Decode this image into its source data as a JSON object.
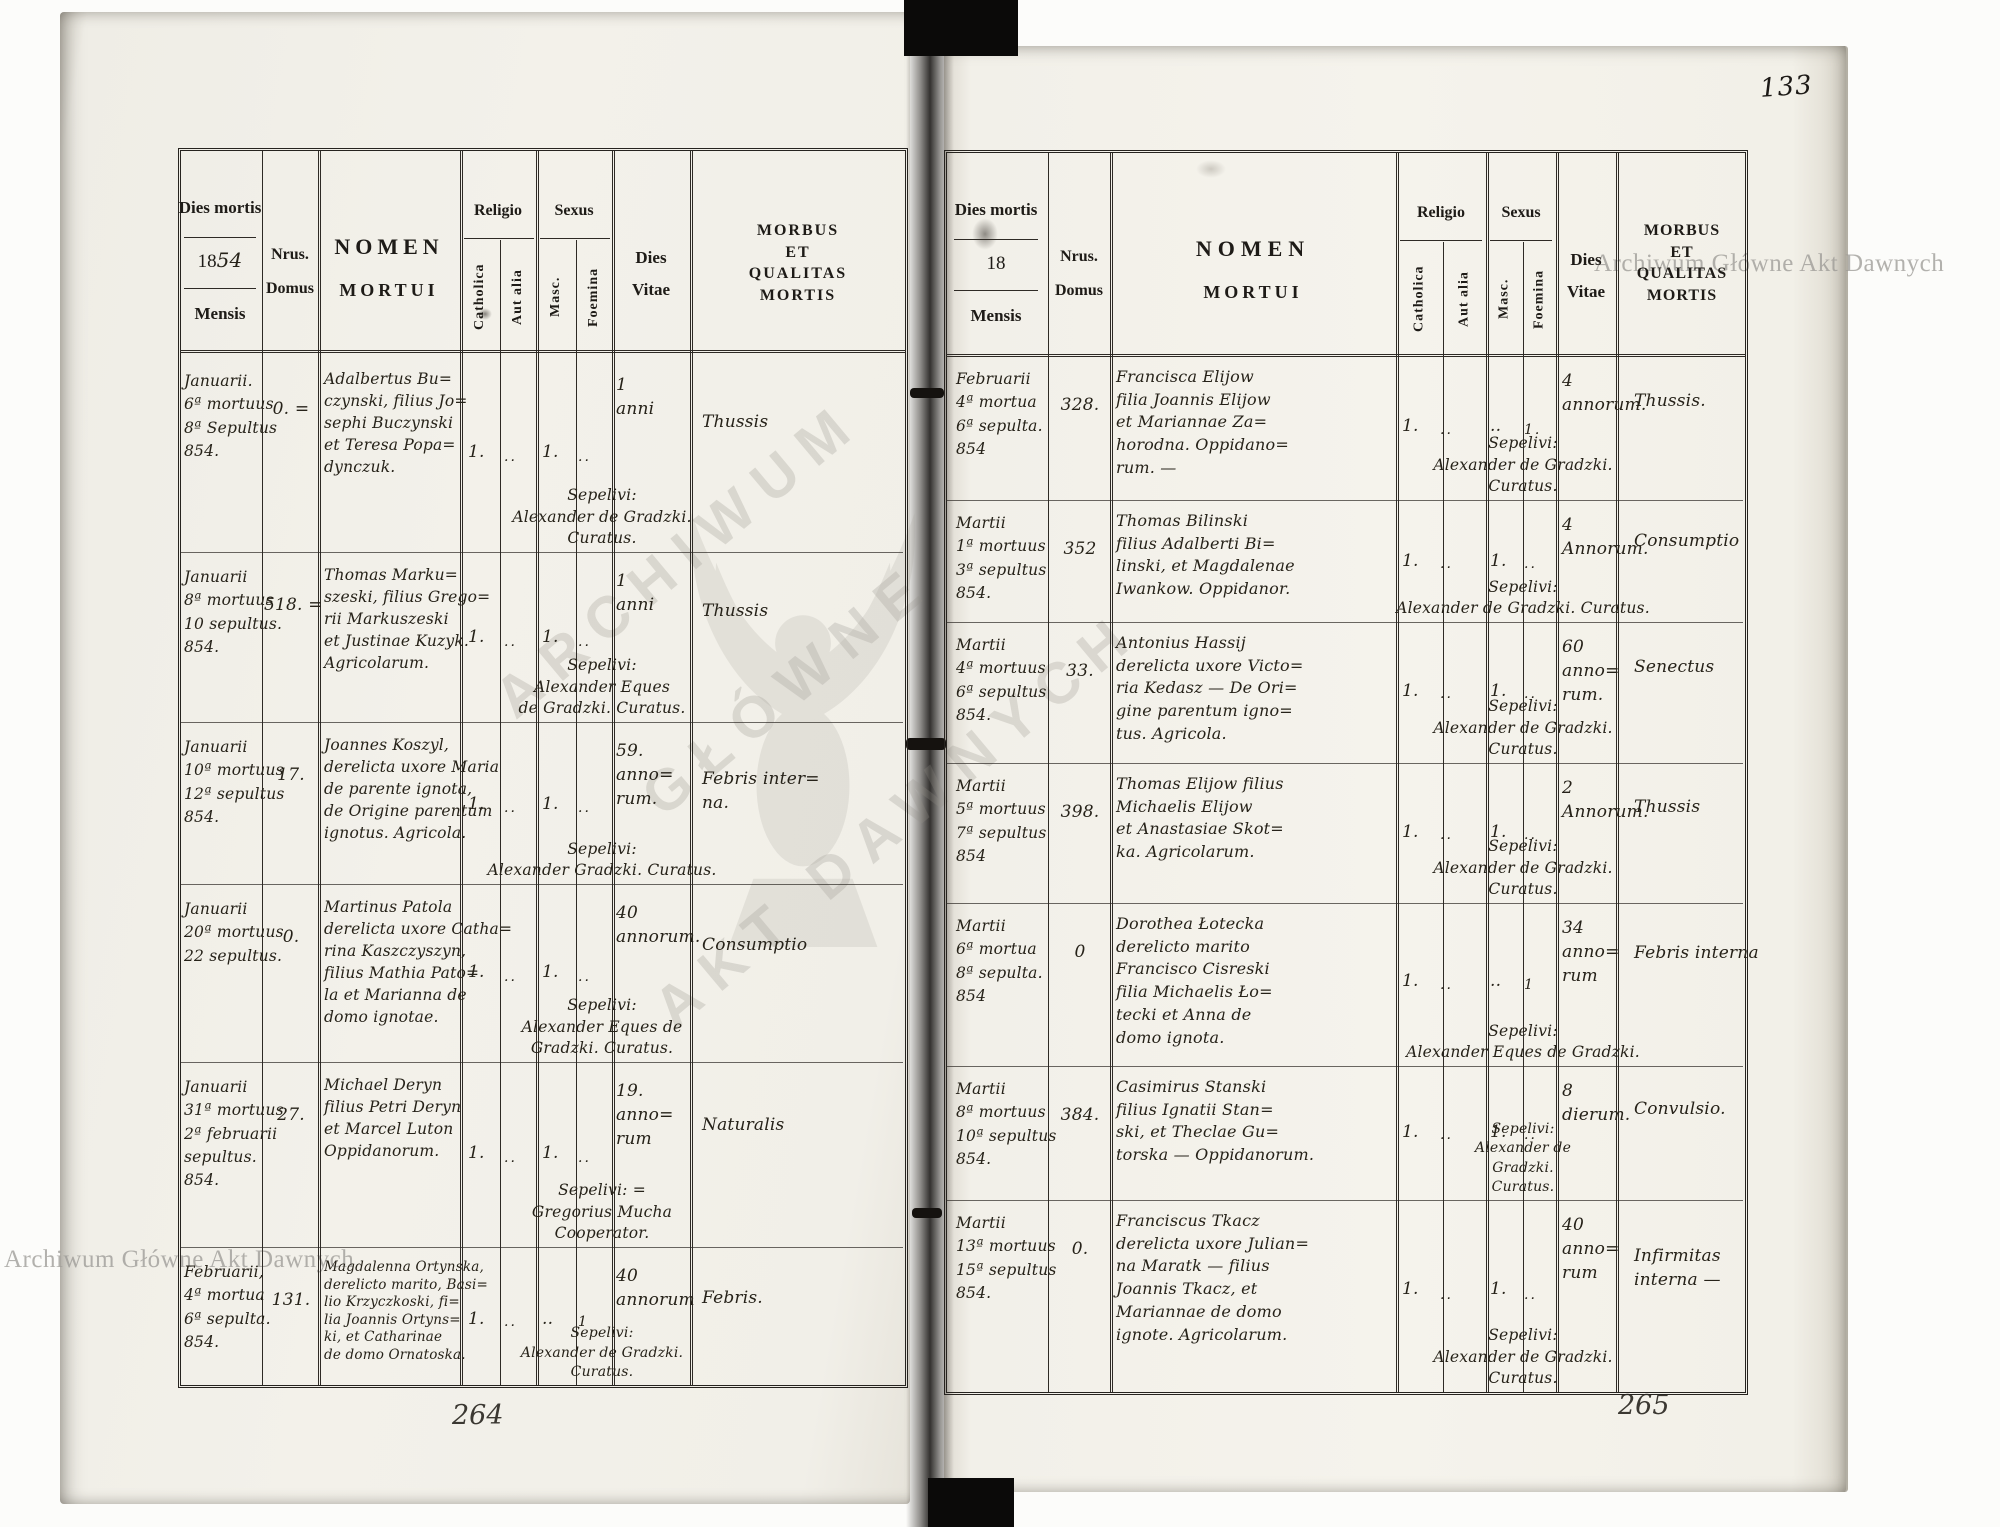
{
  "page_number": "133",
  "colors": {
    "paper": "#f3f1ea",
    "ink": "#262219",
    "print": "#1e1b17"
  },
  "watermark": {
    "corner_text": "Archiwum Główne Akt Dawnych",
    "center_line1": "ARCHIWUM",
    "center_line2": "GŁÓWNE",
    "center_line3": "AKT DAWNYCH"
  },
  "headers": {
    "dies_mortis": "Dies mortis",
    "year_printed": "18",
    "mensis": "Mensis",
    "nrus": "Nrus.",
    "domus": "Domus",
    "nomen_line1": "NOMEN",
    "nomen_line2": "MORTUI",
    "religio": "Religio",
    "catholica": "Catholica",
    "aut_alia": "Aut alia",
    "sexus": "Sexus",
    "masc": "Masc.",
    "foemina": "Foemina",
    "dies": "Dies",
    "vitae": "Vitae",
    "morbus": "MORBUS\nET\nQUALITAS\nMORTIS"
  },
  "left_page": {
    "year_suffix": "54",
    "folio": "264",
    "rows": [
      {
        "dies": "Januarii.\n6ª mortuus\n8ª Sepultus\n854.",
        "nrus": "0. =",
        "nomen": "Adalbertus Bu=\nczynski, filius Jo=\nsephi Buczynski\net Teresa Popa=\ndynczuk.",
        "catholica": "1.",
        "aut_alia": "..",
        "masc": "1.",
        "foemina": "..",
        "vitae": "1\nanni",
        "morbus": "Thussis",
        "sepelivi": "Sepelivi:\nAlexander de Gradzki.\nCuratus."
      },
      {
        "dies": "Januarii\n8ª mortuus\n10 sepultus.\n854.",
        "nrus": "518. =",
        "nomen": "Thomas Marku=\nszeski, filius Grego=\nrii Markuszeski\net Justinae Kuzyk.\nAgricolarum.",
        "catholica": "1.",
        "aut_alia": "..",
        "masc": "1.",
        "foemina": "..",
        "vitae": "1\nanni",
        "morbus": "Thussis",
        "sepelivi": "Sepelivi:\nAlexander Eques\nde Gradzki. Curatus."
      },
      {
        "dies": "Januarii\n10ª mortuus\n12ª sepultus\n854.",
        "nrus": "17.",
        "nomen": "Joannes Koszyl,\nderelicta uxore Maria\nde parente ignota,\nde Origine parentum\nignotus. Agricola.",
        "catholica": "1.",
        "aut_alia": "..",
        "masc": "1.",
        "foemina": "..",
        "vitae": "59.\nanno=\nrum.",
        "morbus": "Febris inter=\nna.",
        "sepelivi": "Sepelivi:\nAlexander Gradzki. Curatus."
      },
      {
        "dies": "Januarii\n20ª mortuus\n22 sepultus.",
        "nrus": "0.",
        "nomen": "Martinus Patola\nderelicta uxore Catha=\nrina Kaszczyszyn,\nfilius Mathia Pato=\nla et Marianna de\ndomo ignotae.",
        "catholica": "1.",
        "aut_alia": "..",
        "masc": "1.",
        "foemina": "..",
        "vitae": "40\nannorum.",
        "morbus": "Consumptio",
        "sepelivi": "Sepelivi:\nAlexander Eques de\nGradzki. Curatus."
      },
      {
        "dies": "Januarii\n31ª mortuus\n2ª februarii\nsepultus.\n854.",
        "nrus": "27.",
        "nomen": "Michael Deryn\nfilius Petri Deryn\net Marcel Luton\nOppidanorum.",
        "catholica": "1.",
        "aut_alia": "..",
        "masc": "1.",
        "foemina": "..",
        "vitae": "19.\nanno=\nrum",
        "morbus": "Naturalis",
        "sepelivi": "Sepelivi: =\nGregorius Mucha\nCooperator."
      },
      {
        "dies": "Februarii,\n4ª mortua\n6ª sepulta.\n854.",
        "nrus": "131.",
        "nomen": "Magdalenna Ortynska,\nderelicto marito, Basi=\nlio Krzyczkoski, fi=\nlia Joannis Ortyns=\nki, et Catharinae\nde domo Ornatoska.",
        "catholica": "1.",
        "aut_alia": "..",
        "masc": "..",
        "foemina": "1",
        "vitae": "40\nannorum",
        "morbus": "Febris.",
        "sepelivi": "Sepelivi:\nAlexander de Gradzki.\nCuratus."
      }
    ]
  },
  "right_page": {
    "year_suffix": "",
    "folio": "265",
    "rows": [
      {
        "dies": "Februarii\n4ª mortua\n6ª sepulta.\n854",
        "nrus": "328.",
        "nomen": "Francisca Elijow\nfilia Joannis Elijow\net Mariannae Za=\nhorodna. Oppidano=\nrum. —",
        "catholica": "1.",
        "aut_alia": "..",
        "masc": "..",
        "foemina": "1.",
        "vitae": "4\nannorum.",
        "morbus": "Thussis.",
        "sepelivi": "Sepelivi:\nAlexander de Gradzki.\nCuratus."
      },
      {
        "dies": "Martii\n1ª mortuus\n3ª sepultus\n854.",
        "nrus": "352",
        "nomen": "Thomas Bilinski\nfilius Adalberti Bi=\nlinski, et Magdalenae\nIwankow. Oppidanor.",
        "catholica": "1.",
        "aut_alia": "..",
        "masc": "1.",
        "foemina": "..",
        "vitae": "4\nAnnorum.",
        "morbus": "Consumptio",
        "sepelivi": "Sepelivi:\nAlexander de Gradzki. Curatus."
      },
      {
        "dies": "Martii\n4ª mortuus\n6ª sepultus\n854.",
        "nrus": "33.",
        "nomen": "Antonius Hassij\nderelicta uxore Victo=\nria Kedasz — De Ori=\ngine parentum igno=\ntus. Agricola.",
        "catholica": "1.",
        "aut_alia": "..",
        "masc": "1.",
        "foemina": "..",
        "vitae": "60\nanno=\nrum.",
        "morbus": "Senectus",
        "sepelivi": "Sepelivi:\nAlexander de Gradzki.\nCuratus."
      },
      {
        "dies": "Martii\n5ª mortuus\n7ª sepultus\n854",
        "nrus": "398.",
        "nomen": "Thomas Elijow filius\nMichaelis Elijow\net Anastasiae Skot=\nka. Agricolarum.",
        "catholica": "1.",
        "aut_alia": "..",
        "masc": "1.",
        "foemina": "..",
        "vitae": "2\nAnnorum.",
        "morbus": "Thussis",
        "sepelivi": "Sepelivi:\nAlexander de Gradzki.\nCuratus."
      },
      {
        "dies": "Martii\n6ª mortua\n8ª sepulta.\n854",
        "nrus": "0",
        "nomen": "Dorothea Łotecka\nderelicto marito\nFrancisco Cisreski\nfilia Michaelis Ło=\ntecki et Anna de\ndomo ignota.",
        "catholica": "1.",
        "aut_alia": "..",
        "masc": "..",
        "foemina": "1",
        "vitae": "34\nanno=\nrum",
        "morbus": "Febris interna",
        "sepelivi": "Sepelivi:\nAlexander Eques de Gradzki."
      },
      {
        "dies": "Martii\n8ª mortuus\n10ª sepultus\n854.",
        "nrus": "384.",
        "nomen": "Casimirus Stanski\nfilius Ignatii Stan=\nski, et Theclae Gu=\ntorska — Oppidanorum.",
        "catholica": "1.",
        "aut_alia": "..",
        "masc": "1.",
        "foemina": "..",
        "vitae": "8\ndierum.",
        "morbus": "Convulsio.",
        "sepelivi": "Sepelivi:\nAlexander de\nGradzki.\nCuratus."
      },
      {
        "dies": "Martii\n13ª mortuus\n15ª sepultus\n854.",
        "nrus": "0.",
        "nomen": "Franciscus Tkacz\nderelicta uxore Julian=\nna Maratk — filius\nJoannis Tkacz, et\nMariannae de domo\nignote. Agricolarum.",
        "catholica": "1.",
        "aut_alia": "..",
        "masc": "1.",
        "foemina": "..",
        "vitae": "40\nanno=\nrum",
        "morbus": "Infirmitas\ninterna —",
        "sepelivi": "Sepelivi:\nAlexander de Gradzki.\nCuratus."
      }
    ]
  }
}
